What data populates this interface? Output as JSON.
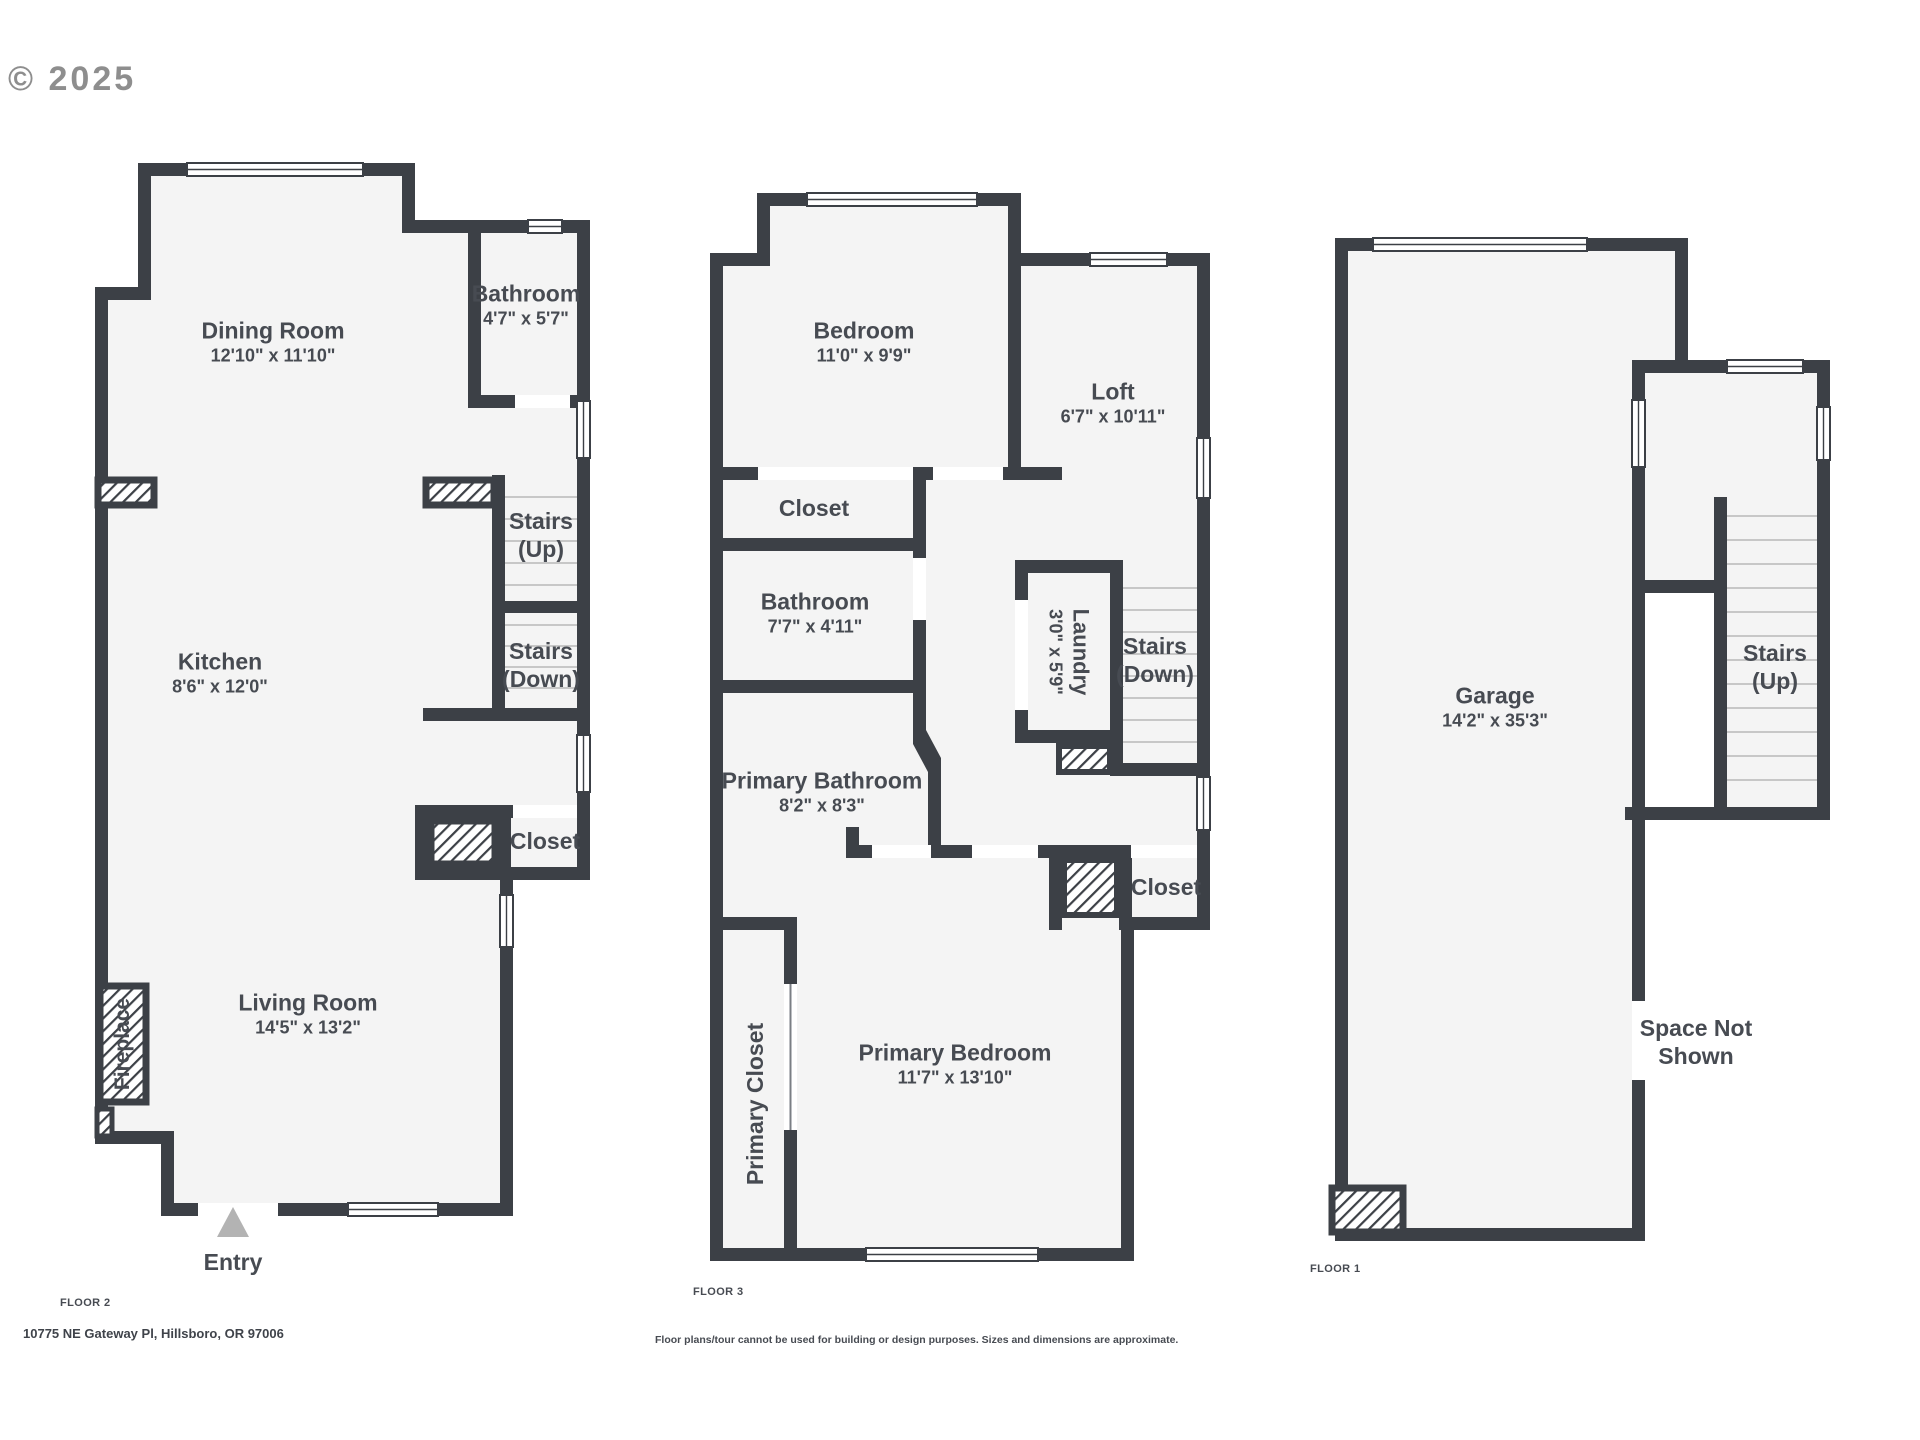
{
  "watermark": "© 2025",
  "colors": {
    "wall": "#3c4046",
    "floor_fill": "#f4f4f4",
    "stair_tread": "#c7c7c7",
    "label_text": "#474b52",
    "watermark_gray": "#8e8e8e",
    "entry_arrow": "#b3b3b3"
  },
  "floor2": {
    "tag": "FLOOR 2",
    "dining": {
      "name": "Dining Room",
      "dims": "12'10\" x 11'10\""
    },
    "bathroom": {
      "name": "Bathroom",
      "dims": "4'7\" x 5'7\""
    },
    "kitchen": {
      "name": "Kitchen",
      "dims": "8'6\" x 12'0\""
    },
    "stairs_up": {
      "name": "Stairs",
      "sub": "(Up)"
    },
    "stairs_down": {
      "name": "Stairs",
      "sub": "(Down)"
    },
    "closet": {
      "name": "Closet"
    },
    "living": {
      "name": "Living Room",
      "dims": "14'5\" x 13'2\""
    },
    "fireplace": {
      "name": "Fireplace"
    },
    "entry": {
      "name": "Entry"
    }
  },
  "floor3": {
    "tag": "FLOOR 3",
    "bedroom": {
      "name": "Bedroom",
      "dims": "11'0\" x 9'9\""
    },
    "loft": {
      "name": "Loft",
      "dims": "6'7\" x 10'11\""
    },
    "closet_top": {
      "name": "Closet"
    },
    "bathroom": {
      "name": "Bathroom",
      "dims": "7'7\" x 4'11\""
    },
    "laundry": {
      "name": "Laundry",
      "dims": "3'0\" x 5'9\""
    },
    "stairs_down": {
      "name": "Stairs",
      "sub": "(Down)"
    },
    "primary_bathroom": {
      "name": "Primary Bathroom",
      "dims": "8'2\" x 8'3\""
    },
    "closet_right": {
      "name": "Closet"
    },
    "primary_bedroom": {
      "name": "Primary Bedroom",
      "dims": "11'7\" x 13'10\""
    },
    "primary_closet": {
      "name": "Primary Closet"
    }
  },
  "floor1": {
    "tag": "FLOOR 1",
    "garage": {
      "name": "Garage",
      "dims": "14'2\" x 35'3\""
    },
    "stairs_up": {
      "name": "Stairs",
      "sub": "(Up)"
    },
    "space_not_shown": {
      "line1": "Space Not",
      "line2": "Shown"
    }
  },
  "footer": {
    "address": "10775 NE Gateway Pl, Hillsboro, OR 97006",
    "disclaimer": "Floor plans/tour cannot be used for building or design purposes. Sizes and dimensions are approximate."
  }
}
